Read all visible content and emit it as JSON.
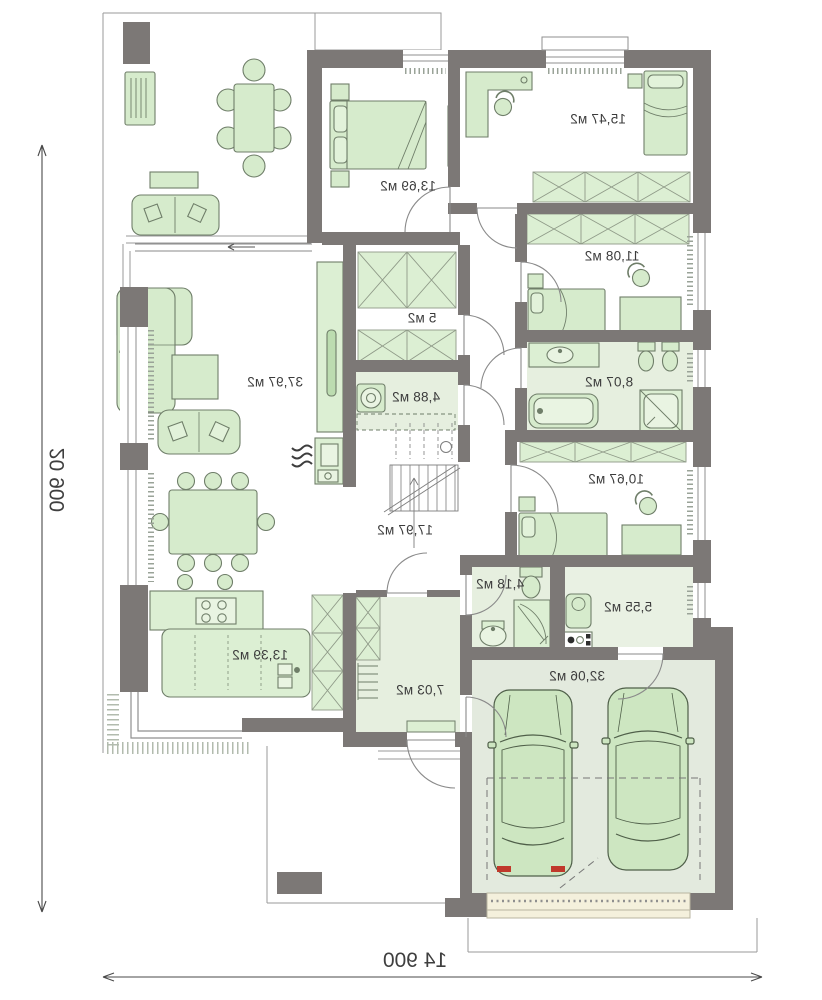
{
  "plan": {
    "title": "house-floor-plan-mirrored",
    "rooms": [
      {
        "name": "living-room",
        "area": "37,97 м2"
      },
      {
        "name": "bedroom-top",
        "area": "13,69 м2"
      },
      {
        "name": "bedroom-corner",
        "area": "15,47 м2"
      },
      {
        "name": "bedroom-middle",
        "area": "11,08 м2"
      },
      {
        "name": "bathroom-main",
        "area": "8,07 м2"
      },
      {
        "name": "bedroom-lower",
        "area": "10,67 м2"
      },
      {
        "name": "wardrobe-closet",
        "area": "5 м2"
      },
      {
        "name": "laundry-room",
        "area": "4,88 м2"
      },
      {
        "name": "hall",
        "area": "17,97 м2"
      },
      {
        "name": "kitchen",
        "area": "13,39 м2"
      },
      {
        "name": "corridor",
        "area": "7,03 м2"
      },
      {
        "name": "bathroom-small",
        "area": "4,18 м2"
      },
      {
        "name": "technical-room",
        "area": "5,55 м2"
      },
      {
        "name": "garage",
        "area": "32,06 м2"
      }
    ],
    "dimensions": {
      "total_depth": "20 900",
      "total_width": "14 900"
    },
    "colors": {
      "wall": "#7c7876",
      "furniture_fill": "#d6ebcc",
      "furniture_stroke": "#6f7e69",
      "wardrobe_fill": "#dcefd3",
      "floor_green": "#e6efdf",
      "garage_floor": "#e3eade",
      "apron_beige": "#f4f0dc",
      "taillight_red": "#c0392b",
      "thin_line": "#8f8f8f",
      "text": "#3c3c3c"
    },
    "furniture_icons": [
      "grill-icon",
      "outdoor-table-icon",
      "sofa-icon",
      "corner-sofa-icon",
      "coffee-table-icon",
      "double-bed-icon",
      "single-bed-icon",
      "desk-icon",
      "office-chair-icon",
      "wardrobe-x-icon",
      "washing-machine-icon",
      "staircase-icon",
      "fireplace-icon",
      "kitchen-island-icon",
      "cooktop-icon",
      "bar-stool-icon",
      "dining-table-icon",
      "bathtub-icon",
      "shower-icon",
      "toilet-icon",
      "washbasin-icon",
      "boiler-icon",
      "car-icon",
      "coat-rack-icon"
    ]
  }
}
